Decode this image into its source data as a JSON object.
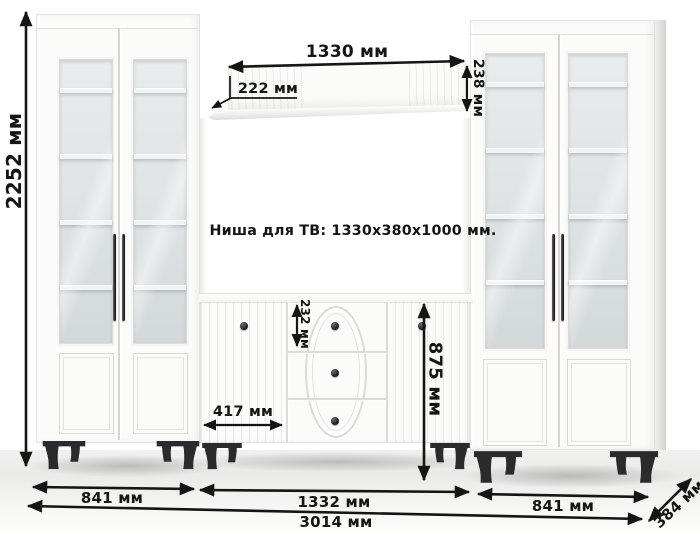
{
  "diagram": {
    "tv_niche_note": "Ниша для ТВ: 1330x380x1000 мм.",
    "dimensions": {
      "total_height": "2252 мм",
      "shelf_width": "1330 мм",
      "shelf_ledge_depth": "222 мм",
      "shelf_panel_height": "238 мм",
      "top_drawer_height": "232 мм",
      "commode_height": "875 мм",
      "commode_door_width": "417 мм",
      "left_cabinet_width": "841 мм",
      "commode_width": "1332 мм",
      "right_cabinet_width": "841 мм",
      "total_width": "3014 мм",
      "unit_depth": "384 мм"
    },
    "colors": {
      "dimension_ink": "#151515",
      "cabinet_white": "#fbfbf9",
      "glass": "#dde2e3",
      "leg_black": "#2b2b2e",
      "background": "#ffffff"
    }
  }
}
